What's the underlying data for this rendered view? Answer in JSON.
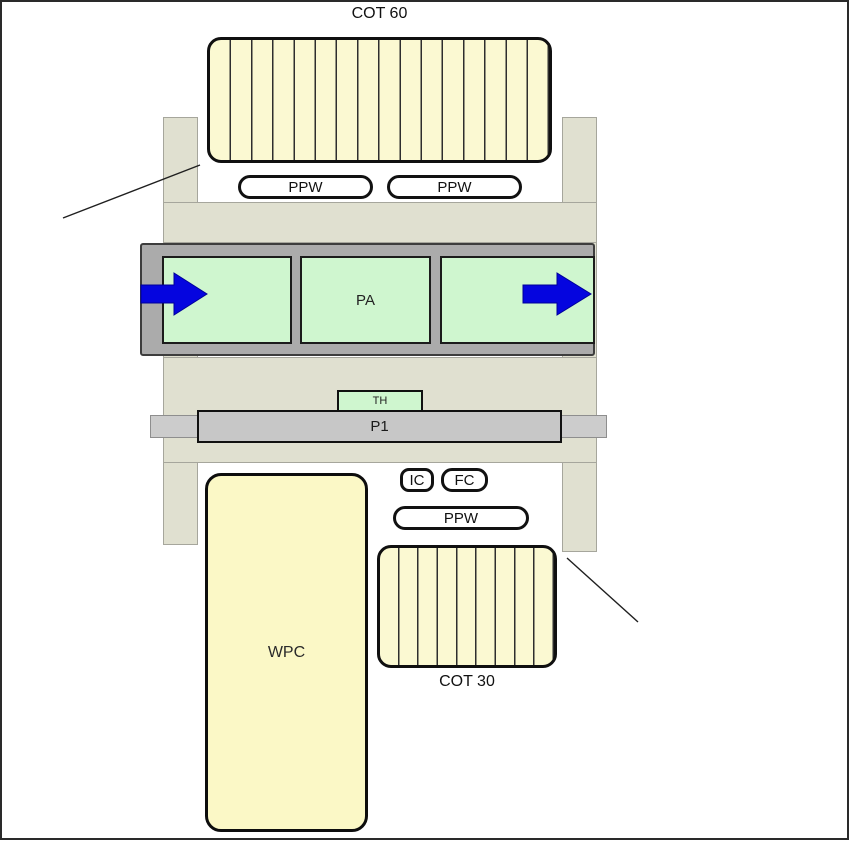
{
  "diagram": {
    "labels": {
      "cot60": "COT 60",
      "ppw_top_left": "PPW",
      "ppw_top_right": "PPW",
      "pa": "PA",
      "th": "TH",
      "p1": "P1",
      "ic": "IC",
      "fc": "FC",
      "ppw_bottom": "PPW",
      "wpc": "WPC",
      "cot30": "COT 30"
    },
    "icons": {
      "inlet_arrow": "arrow-right-icon",
      "outlet_arrow": "arrow-right-icon",
      "left_annotation": "leader-line",
      "right_annotation": "leader-line"
    },
    "colors": {
      "arrow_blue": "#0505DF",
      "cell_green": "#CFF6CF",
      "coil_yellow": "#FBF9D2",
      "wpc_yellow": "#FBF8C6",
      "frame_olive": "#E0E0D0",
      "conveyor_gray": "#ABABAB",
      "plate_gray": "#C7C7C7"
    }
  }
}
